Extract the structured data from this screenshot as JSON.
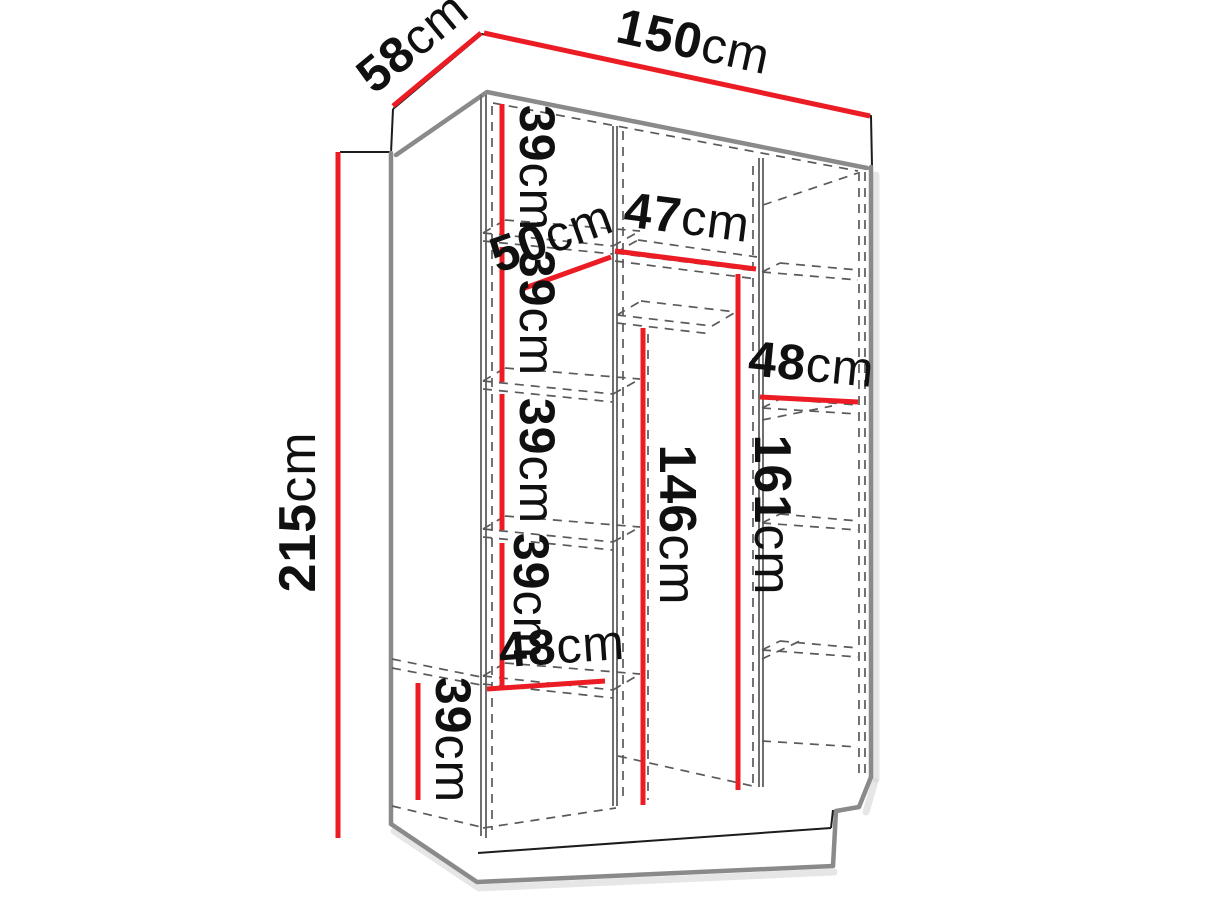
{
  "diagram": {
    "kind": "furniture-dimension-diagram",
    "subject": "three-section wardrobe technical line drawing with internal shelf dimensions",
    "unit": "cm",
    "colors": {
      "accent": "#ec1c24",
      "ink": "#1c1c1c",
      "frame": "#8a8a8a",
      "background": "#ffffff"
    },
    "overall": {
      "width_cm": 150,
      "depth_cm": 58,
      "height_cm": 215
    },
    "labels": {
      "width_top": {
        "num": "150",
        "unit": "cm",
        "value": 150,
        "meaning": "overall width"
      },
      "depth_top": {
        "num": "58",
        "unit": "cm",
        "value": 58,
        "meaning": "overall depth"
      },
      "height_left": {
        "num": "215",
        "unit": "cm",
        "value": 215,
        "meaning": "overall height"
      },
      "left_shelf_1": {
        "num": "39",
        "unit": "cm",
        "value": 39,
        "meaning": "left column compartment height 1"
      },
      "left_shelf_2": {
        "num": "39",
        "unit": "cm",
        "value": 39,
        "meaning": "left column compartment height 2"
      },
      "left_shelf_3": {
        "num": "39",
        "unit": "cm",
        "value": 39,
        "meaning": "left column compartment height 3"
      },
      "left_shelf_4": {
        "num": "39",
        "unit": "cm",
        "value": 39,
        "meaning": "left column compartment height 4"
      },
      "left_bottom_shelf": {
        "num": "39",
        "unit": "cm",
        "value": 39,
        "meaning": "bottom left compartment height"
      },
      "left_width_top": {
        "num": "50",
        "unit": "cm",
        "value": 50,
        "meaning": "left column width at top"
      },
      "left_width_bottom": {
        "num": "48",
        "unit": "cm",
        "value": 48,
        "meaning": "left column width at bottom"
      },
      "middle_shelf_width": {
        "num": "47",
        "unit": "cm",
        "value": 47,
        "meaning": "middle column top shelf width"
      },
      "middle_inner_height": {
        "num": "146",
        "unit": "cm",
        "value": 146,
        "meaning": "middle hanging space height"
      },
      "middle_full_height": {
        "num": "161",
        "unit": "cm",
        "value": 161,
        "meaning": "middle column height below top shelf"
      },
      "right_width": {
        "num": "48",
        "unit": "cm",
        "value": 48,
        "meaning": "right column width"
      }
    }
  }
}
